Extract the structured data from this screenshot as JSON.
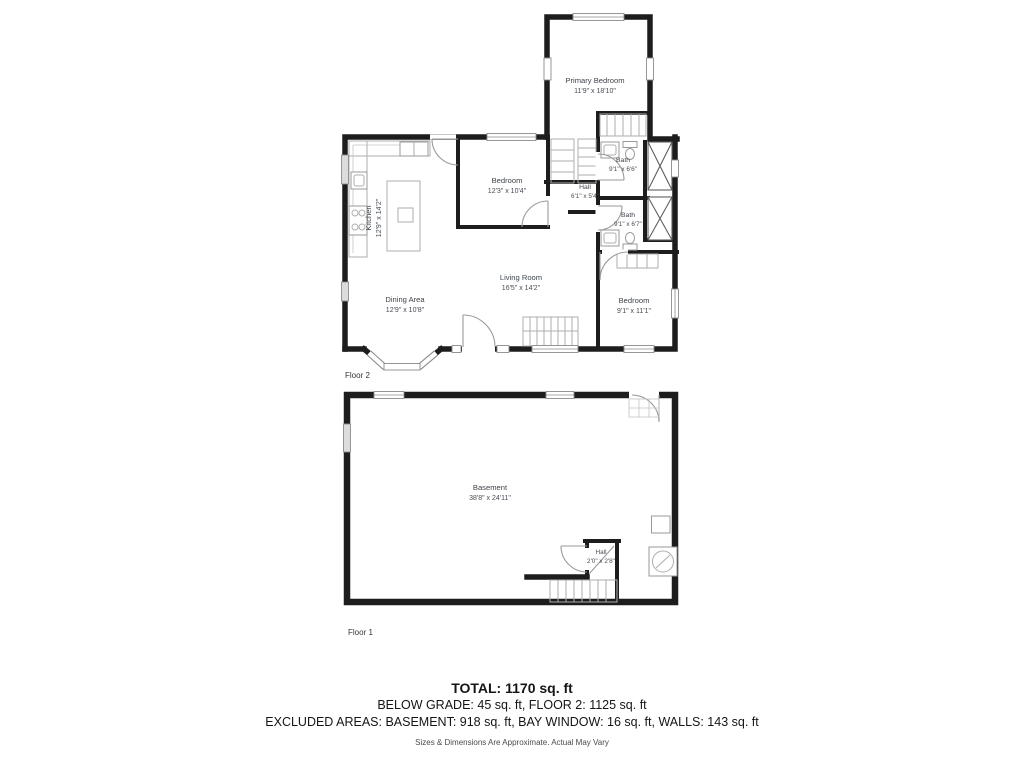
{
  "colors": {
    "wall": "#1d1d1d",
    "label": "#3e434b",
    "background": "#ffffff"
  },
  "floor2": {
    "name": "Floor 2",
    "rooms": [
      {
        "id": "primary-bedroom",
        "label": "Primary Bedroom",
        "dims": "11'9\" x 18'10\""
      },
      {
        "id": "bedroom-top",
        "label": "Bedroom",
        "dims": "12'3\" x 10'4\""
      },
      {
        "id": "hall",
        "label": "Hall",
        "dims": "6'1\" x 5'4\""
      },
      {
        "id": "bath-upper",
        "label": "Bath",
        "dims": "9'1\" x 6'6\""
      },
      {
        "id": "bath-lower",
        "label": "Bath",
        "dims": "9'1\" x 6'7\""
      },
      {
        "id": "bedroom-right",
        "label": "Bedroom",
        "dims": "9'1\" x 11'1\""
      },
      {
        "id": "kitchen",
        "label": "Kitchen",
        "dims": "12'9\" x 14'2\""
      },
      {
        "id": "dining-area",
        "label": "Dining Area",
        "dims": "12'9\" x 10'8\""
      },
      {
        "id": "living-room",
        "label": "Living Room",
        "dims": "16'5\" x 14'2\""
      }
    ]
  },
  "floor1": {
    "name": "Floor 1",
    "rooms": [
      {
        "id": "basement",
        "label": "Basement",
        "dims": "38'8\" x 24'11\""
      },
      {
        "id": "hall",
        "label": "Hall",
        "dims": "2'0\" x 2'8\""
      }
    ]
  },
  "summary": {
    "total": "TOTAL: 1170 sq. ft",
    "grade_line": "BELOW GRADE: 45 sq. ft, FLOOR 2: 1125 sq. ft",
    "excluded_line": "EXCLUDED AREAS: BASEMENT: 918 sq. ft, BAY WINDOW: 16 sq. ft, WALLS: 143 sq. ft",
    "disclaimer": "Sizes & Dimensions Are Approximate. Actual May Vary"
  }
}
